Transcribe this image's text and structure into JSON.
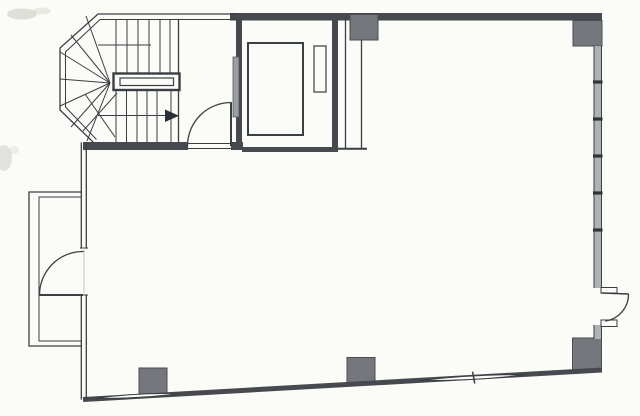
{
  "document": {
    "kind": "scanned-floor-plan",
    "visible_text": [],
    "feature_summary": {
      "stairwell": "U-return stair with winder fan, center handrail and up-arrow",
      "elevator": "shaft with car outline, counterweight and gray landing door",
      "service_duct": "narrow shaft right of elevator",
      "columns_count": 5,
      "doors_count": 3,
      "balcony_side": "left",
      "window_wall_side": "right",
      "bottom_wall": "sloped with two window slits and center tick"
    }
  },
  "colors": {
    "paper": "#fbfbf8",
    "ink": "#3a3f43",
    "wall": "#46494d",
    "column": "#74787c",
    "windowfill": "#aeb2b4",
    "doorgray": "#9b9fa3",
    "smudge": "#d8d7d0"
  }
}
